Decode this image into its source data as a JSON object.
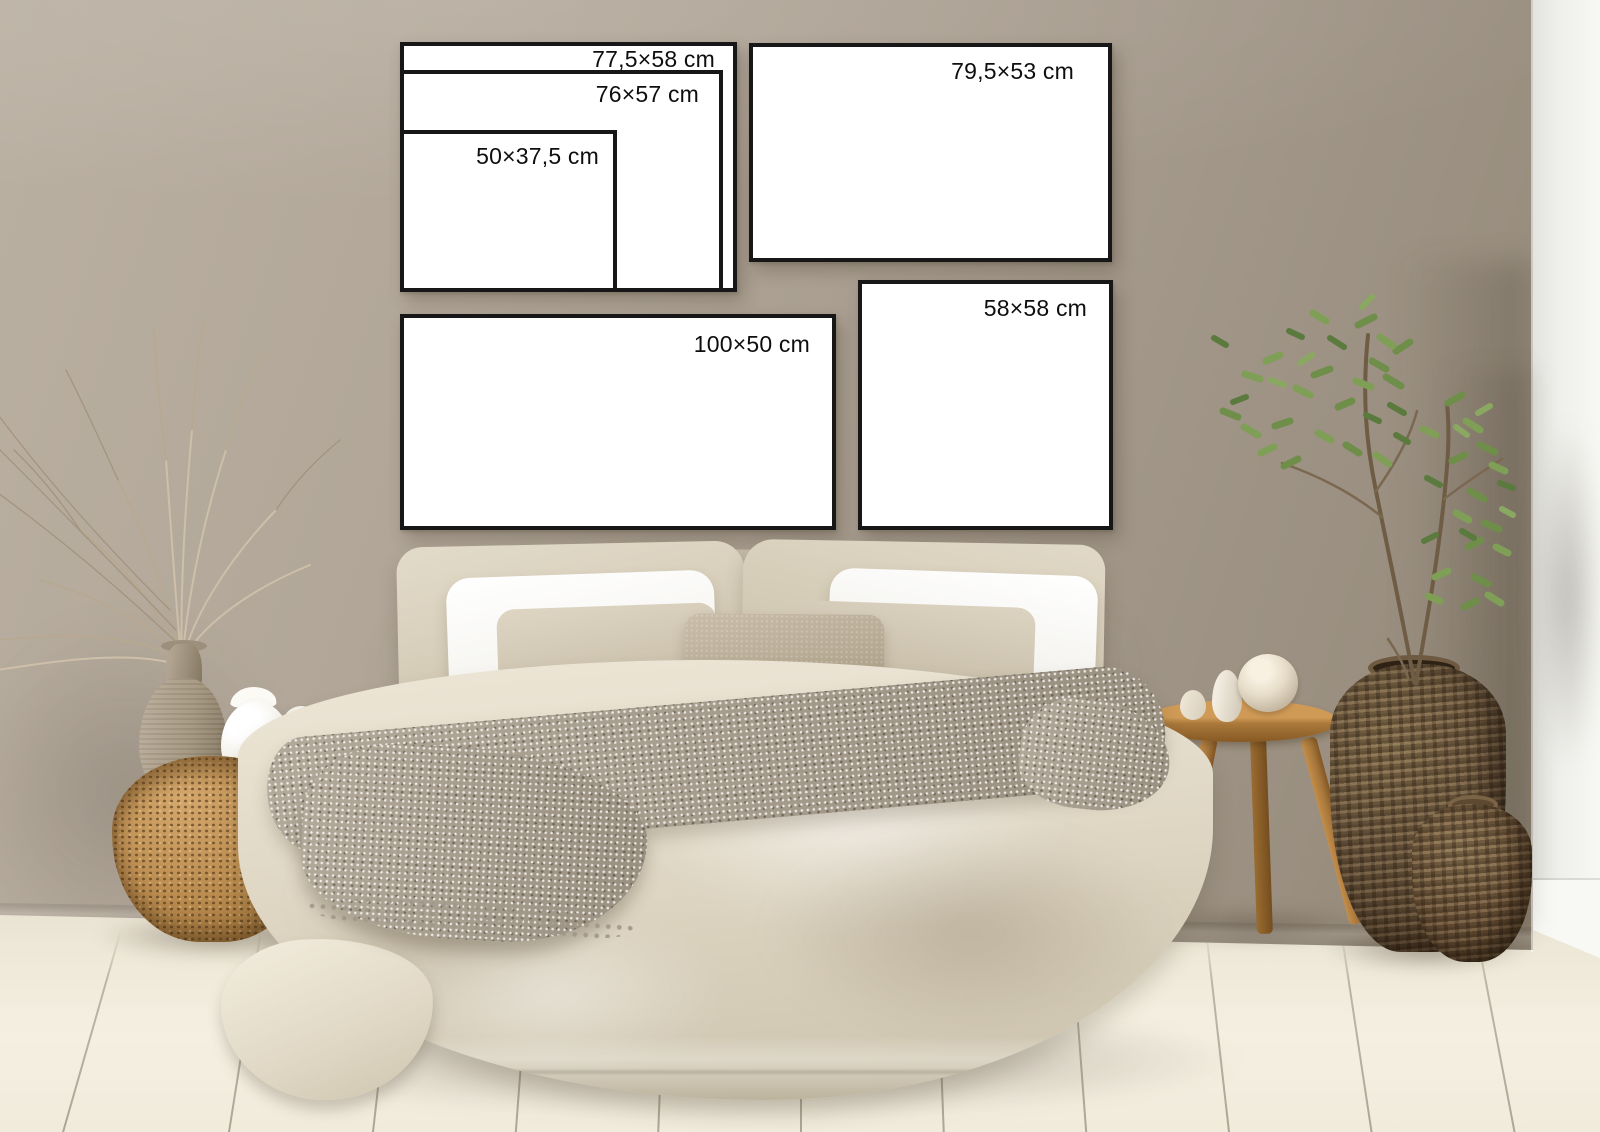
{
  "frames": [
    {
      "name": "size-frame-77-5x58",
      "label": "77,5×58 cm"
    },
    {
      "name": "size-frame-76x57",
      "label": "76×57 cm"
    },
    {
      "name": "size-frame-50x37-5",
      "label": "50×37,5 cm"
    },
    {
      "name": "size-frame-79-5x53",
      "label": "79,5×53 cm"
    },
    {
      "name": "size-frame-100x50",
      "label": "100×50 cm"
    },
    {
      "name": "size-frame-58x58",
      "label": "58×58 cm"
    }
  ],
  "palette": {
    "wall": "#a89d8f",
    "wall_dark": "#93887a",
    "column_white": "#f3f3ef",
    "floor": "#f0ead9",
    "frame_border": "#171717",
    "frame_face": "#ffffff",
    "label_text": "#0e0e0e",
    "duvet": "#e0d8c6",
    "pillow_white": "#fafaf8",
    "pillow_beige": "#d6cdbb",
    "cushion_taupe": "#b3a793",
    "throw_gray": "#a59c8e",
    "wicker_gold": "#bb8d51",
    "wicker_dark": "#6e5a42",
    "wood": "#b5813f",
    "ceramic_taupe": "#a79a88",
    "ceramic_white": "#f7f5f0",
    "plant_green": "#74944e",
    "dried_branch_tan": "#c3b298"
  }
}
